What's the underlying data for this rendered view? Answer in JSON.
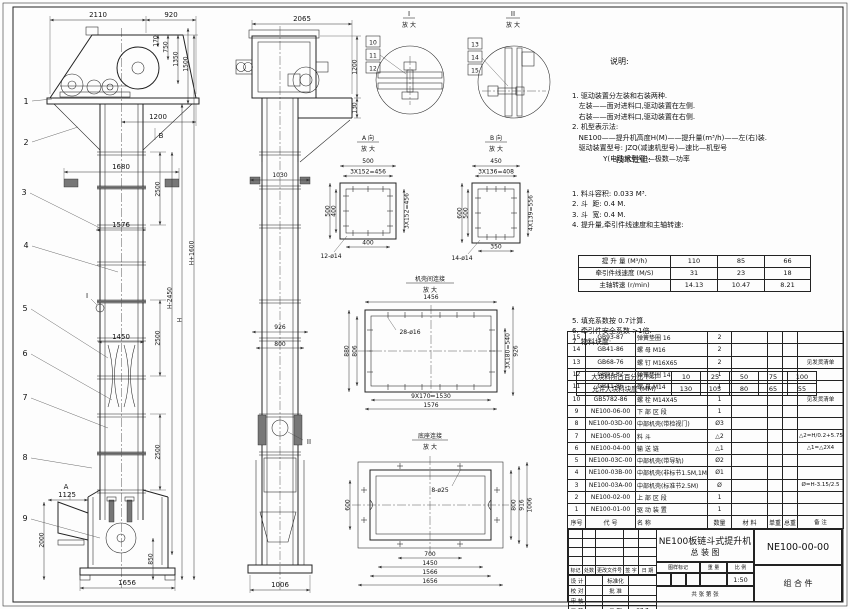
{
  "front": {
    "balloons": [
      "1",
      "2",
      "3",
      "4",
      "5",
      "6",
      "7",
      "8",
      "9"
    ],
    "d2110": "2110",
    "d920": "920",
    "d170": "170",
    "d750": "750",
    "d1350": "1350",
    "d1500": "1500",
    "d1200": "1200",
    "d1680": "1680",
    "d1576": "1576",
    "d1450": "1450",
    "d2500": "2500",
    "dHp": "H+1600",
    "dHm": "H-2450",
    "dH": "H",
    "d1125": "1125",
    "d2000": "2000",
    "d850": "850",
    "d1656": "1656",
    "mA": "A",
    "mB": "B",
    "mI": "I"
  },
  "side": {
    "d2065": "2065",
    "d1200": "1200",
    "d130": "130",
    "d1030": "1030",
    "d926": "926",
    "d800": "800",
    "d1006": "1006",
    "mII": "II"
  },
  "details": {
    "i": {
      "no": "I",
      "mag": "放 大",
      "parts": [
        "10",
        "11",
        "12"
      ]
    },
    "ii": {
      "no": "II",
      "mag": "放 大",
      "parts": [
        "13",
        "14",
        "15"
      ]
    },
    "a": {
      "name": "A 向",
      "mag": "放 大",
      "top": "500",
      "top2": "3X152=456",
      "left": "500",
      "left2": "400",
      "right": "3X152=456",
      "bottom": "400",
      "holes": "12-ø14"
    },
    "b": {
      "name": "B 向",
      "mag": "放 大",
      "top": "450",
      "top2": "3X136=408",
      "left": "600",
      "left2": "500",
      "right": "4X139=556",
      "bottom": "350",
      "holes": "14-ø14"
    },
    "shell": {
      "name": "机壳间连接",
      "mag": "放 大",
      "top": "1456",
      "left": "880",
      "left2": "806",
      "right": "3X180=540",
      "right2": "926",
      "bottom": "9X170=1530",
      "bottom2": "1576",
      "holes": "28-ø16"
    },
    "base": {
      "name": "底座连接",
      "mag": "放 大",
      "left": "600",
      "right": "800",
      "right2": "916",
      "right3": "1006",
      "bottom": "700",
      "bottom2": "1450",
      "bottom3": "1566",
      "bottom4": "1656",
      "holes": "8-ø25"
    }
  },
  "notes": {
    "heading": "说明:",
    "lines": [
      "1. 驱动装置分左装和右装两种.",
      "   左装——面对进料口,驱动装置在左侧.",
      "   右装——面对进料口,驱动装置在右侧.",
      "2. 机型表示法:",
      "   NE100——提升机高度H(M)——提升量(m³/h)——左(右)装.",
      "   驱动装置型号: JZQ(减速机型号)—速比—机型号",
      "              Y(电动机型号)—极数—功率"
    ]
  },
  "specs": {
    "heading": "技术性能:",
    "items": [
      "1. 料斗容积: 0.033 M³.",
      "2. 斗  距: 0.4 M.",
      "3. 斗  宽: 0.4 M.",
      "4. 提升量,牵引件线速度和主轴转速:"
    ],
    "table1": {
      "rows": [
        [
          "提 升 量 (M³/h)",
          "110",
          "85",
          "66"
        ],
        [
          "牵引件线速度 (M/S)",
          "31",
          "23",
          "18"
        ],
        [
          "主轴转速 (r/min)",
          "14.13",
          "10.47",
          "8.21"
        ]
      ]
    },
    "items2": [
      "5. 填充系数按 0.7计算.",
      "6. 牵引件安全系数 >1倍.",
      "7. 物料块度:"
    ],
    "table2": {
      "rows": [
        [
          "大块料所占百分比 (%)",
          "10",
          "25",
          "50",
          "75",
          "100"
        ],
        [
          "允许大块料块度 (MM)",
          "130",
          "105",
          "80",
          "65",
          "55"
        ]
      ]
    }
  },
  "parts": {
    "headers": [
      "序号",
      "代  号",
      "名  称",
      "数量",
      "材  料",
      "单重",
      "总重",
      "备 注"
    ],
    "rows": [
      [
        "15",
        "GB93-87",
        "弹簧垫圈  16",
        "2",
        "",
        "",
        "",
        ""
      ],
      [
        "14",
        "GB41-86",
        "螺 母  M16",
        "2",
        "",
        "",
        "",
        ""
      ],
      [
        "13",
        "GB68-76",
        "螺 钉  M16X65",
        "2",
        "",
        "",
        "",
        "见发货清单"
      ],
      [
        "12",
        "GB93-87",
        "弹簧垫圈  14",
        "1",
        "",
        "",
        "",
        ""
      ],
      [
        "11",
        "GB41-86",
        "螺 母  M14",
        "1",
        "",
        "",
        "",
        ""
      ],
      [
        "10",
        "GB5782-86",
        "螺 栓  M14X45",
        "1",
        "",
        "",
        "",
        "见发货清单"
      ],
      [
        "9",
        "NE100-06-00",
        "下 部 区 段",
        "1",
        "",
        "",
        "",
        ""
      ],
      [
        "8",
        "NE100-03D-00",
        "中部机壳(带检视门)",
        "Ø3",
        "",
        "",
        "",
        ""
      ],
      [
        "7",
        "NE100-05-00",
        "料  斗",
        "△2",
        "",
        "",
        "",
        "△2=H/0.2+5.75"
      ],
      [
        "6",
        "NE100-04-00",
        "输 送 链",
        "△1",
        "",
        "",
        "",
        "△1=△2X4"
      ],
      [
        "5",
        "NE100-03C-00",
        "中部机壳(带导轨)",
        "Ø2",
        "",
        "",
        "",
        ""
      ],
      [
        "4",
        "NE100-03B-00",
        "中部机壳(非标节1.5M,1M)",
        "Ø1",
        "",
        "",
        "",
        ""
      ],
      [
        "3",
        "NE100-03A-00",
        "中部机壳(标准节2.5M)",
        "Ø",
        "",
        "",
        "",
        "Ø=H-3.15/2.5"
      ],
      [
        "2",
        "NE100-02-00",
        "上 部 区 段",
        "1",
        "",
        "",
        "",
        ""
      ],
      [
        "1",
        "NE100-01-00",
        "驱 动 装 置",
        "1",
        "",
        "",
        "",
        ""
      ]
    ]
  },
  "title_block": {
    "title_line1": "NE100板链斗式提升机",
    "title_line2": "总  装  图",
    "code": "NE100-00-00",
    "type": "组 合 件",
    "stamp": [
      "图样标记",
      "重 量",
      "比 例"
    ],
    "scale": "1:50",
    "sheet": "共   张   第   张",
    "change_rows": [
      [
        "",
        "",
        "",
        "",
        ""
      ],
      [
        "",
        "",
        "",
        "",
        ""
      ],
      [
        "",
        "",
        "",
        "",
        ""
      ],
      [
        "",
        "",
        "",
        "",
        ""
      ],
      [
        "标记",
        "处数",
        "更改文件号",
        "签 字",
        "日 期"
      ]
    ],
    "sign_rows": [
      [
        "设 计",
        "",
        "标准化",
        ""
      ],
      [
        "校 对",
        "",
        "批 准",
        ""
      ],
      [
        "审 核",
        "",
        "",
        ""
      ],
      [
        "工 艺",
        "",
        "日 期",
        "97.7"
      ]
    ]
  }
}
